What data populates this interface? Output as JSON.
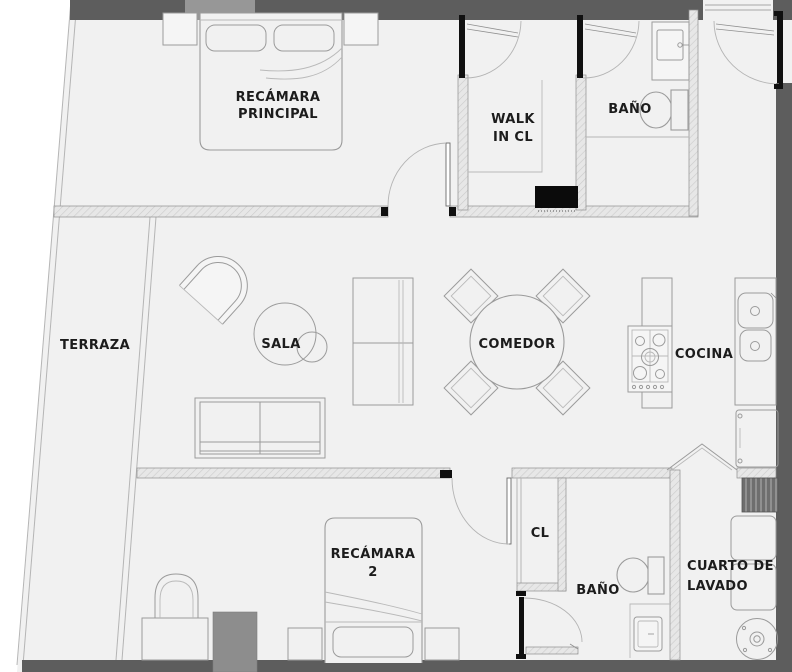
{
  "plan": {
    "title": "apartment-floor-plan",
    "rooms": {
      "recamara_principal": {
        "line1": "RECÁMARA",
        "line2": "PRINCIPAL"
      },
      "walk_in_cl": {
        "line1": "WALK",
        "line2": "IN CL"
      },
      "bano_1": {
        "label": "BAÑO"
      },
      "terraza": {
        "label": "TERRAZA"
      },
      "sala": {
        "label": "SALA"
      },
      "comedor": {
        "label": "COMEDOR"
      },
      "cocina": {
        "label": "COCINA"
      },
      "recamara_2": {
        "line1": "RECÁMARA",
        "line2": "2"
      },
      "closet": {
        "label": "CL"
      },
      "bano_2": {
        "label": "BAÑO"
      },
      "cuarto_lavado": {
        "line1": "CUARTO DE",
        "line2": "LAVADO"
      }
    },
    "colors": {
      "wall_dark": "#5d5d5d",
      "wall_medium": "#979797",
      "floor": "#f1f1f1",
      "line": "#9b9b9b",
      "text": "#1c1c1c",
      "shaft": "#6e6e6e",
      "column": "#8d8d8d",
      "black_box": "#0b0b0b"
    }
  }
}
